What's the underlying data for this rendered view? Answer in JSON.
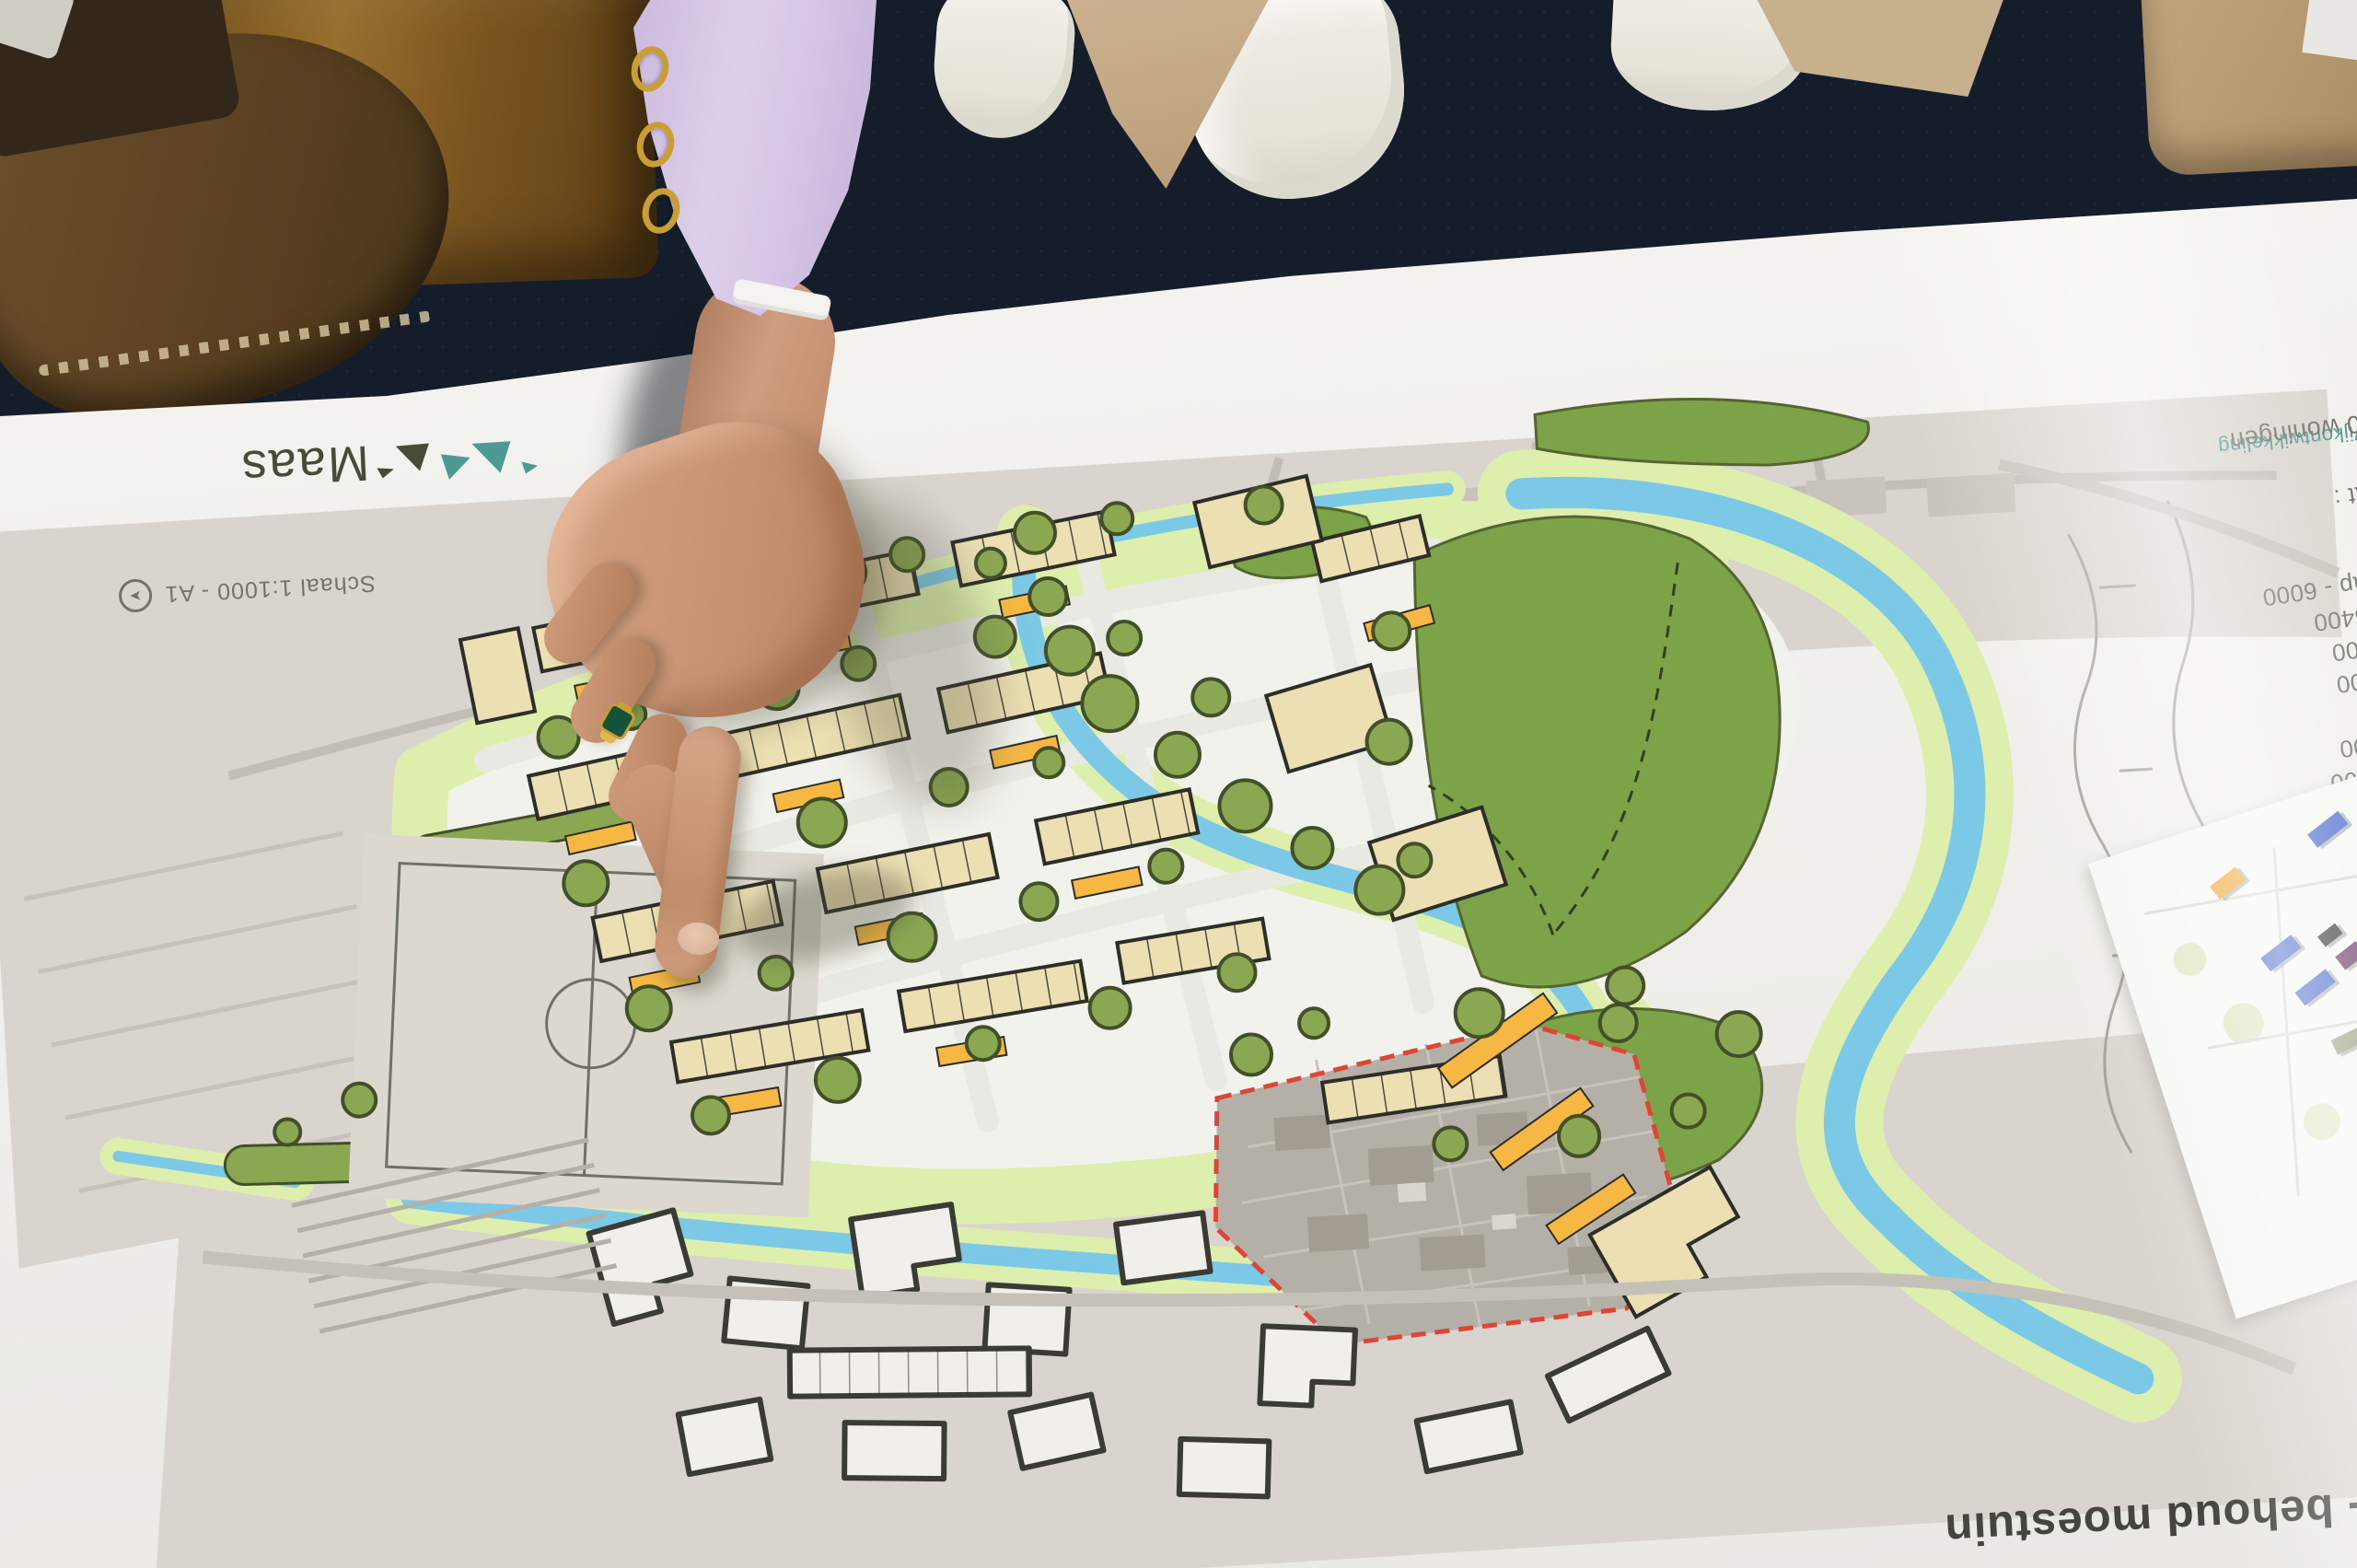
{
  "poster": {
    "logo_text": "Maas",
    "org_label": "Wijkontwikkeling",
    "scale_note": "Schaal 1:1000 - A1",
    "title_fragment": "ek - behoud moestuin",
    "legend_lines": [
      "randweer",
      "oonslim",
      "onzorg",
      "ning - 5400",
      "ing - 3900",
      "ament",
      "op - 6000",
      "en - 5400",
      "den - 5400",
      "een kap - 6000",
      "000",
      "kmaat :",
      "- 240 woningen"
    ]
  },
  "icons": {
    "north_arrow": "➤"
  },
  "colors": {
    "carpet": "#151d2b",
    "paper": "#f0efeb",
    "water": "#7bc9e6",
    "verge": "#ddeead",
    "park": "#7da349",
    "tree_fill": "#8ca752",
    "tree_stroke": "#42502a",
    "building": "#ebdfb3",
    "building_stroke": "#2e2e28",
    "parking": "#f6b843",
    "boundary_red": "#e04434",
    "aerial": "#d9d5ce",
    "moestuin_grey": "#b5b0a7",
    "site_white": "#f2f2ec",
    "street": "#e9e9e3",
    "logo_teal": "#4d9a94",
    "logo_dark": "#474c38",
    "text_grey": "#73736c",
    "title_color": "#45453f",
    "skin": "#cd9b7d",
    "sleeve_lilac": "#d7c6e6",
    "cuff_white": "#f5f3ef",
    "gold": "#c99f33",
    "ring_green": "#14523c",
    "bag_brown": "#7c5a22",
    "boot_brown": "#5e462a",
    "sneaker_white": "#edebe3",
    "coat_beige": "#c7b08c",
    "inset_orange": "#f2a633",
    "inset_blue": "#4a6cce",
    "inset_black": "#3a3a3a",
    "inset_purple": "#6f3d6b",
    "inset_olive": "#9aa07e",
    "inset_pink": "#c4637c"
  }
}
